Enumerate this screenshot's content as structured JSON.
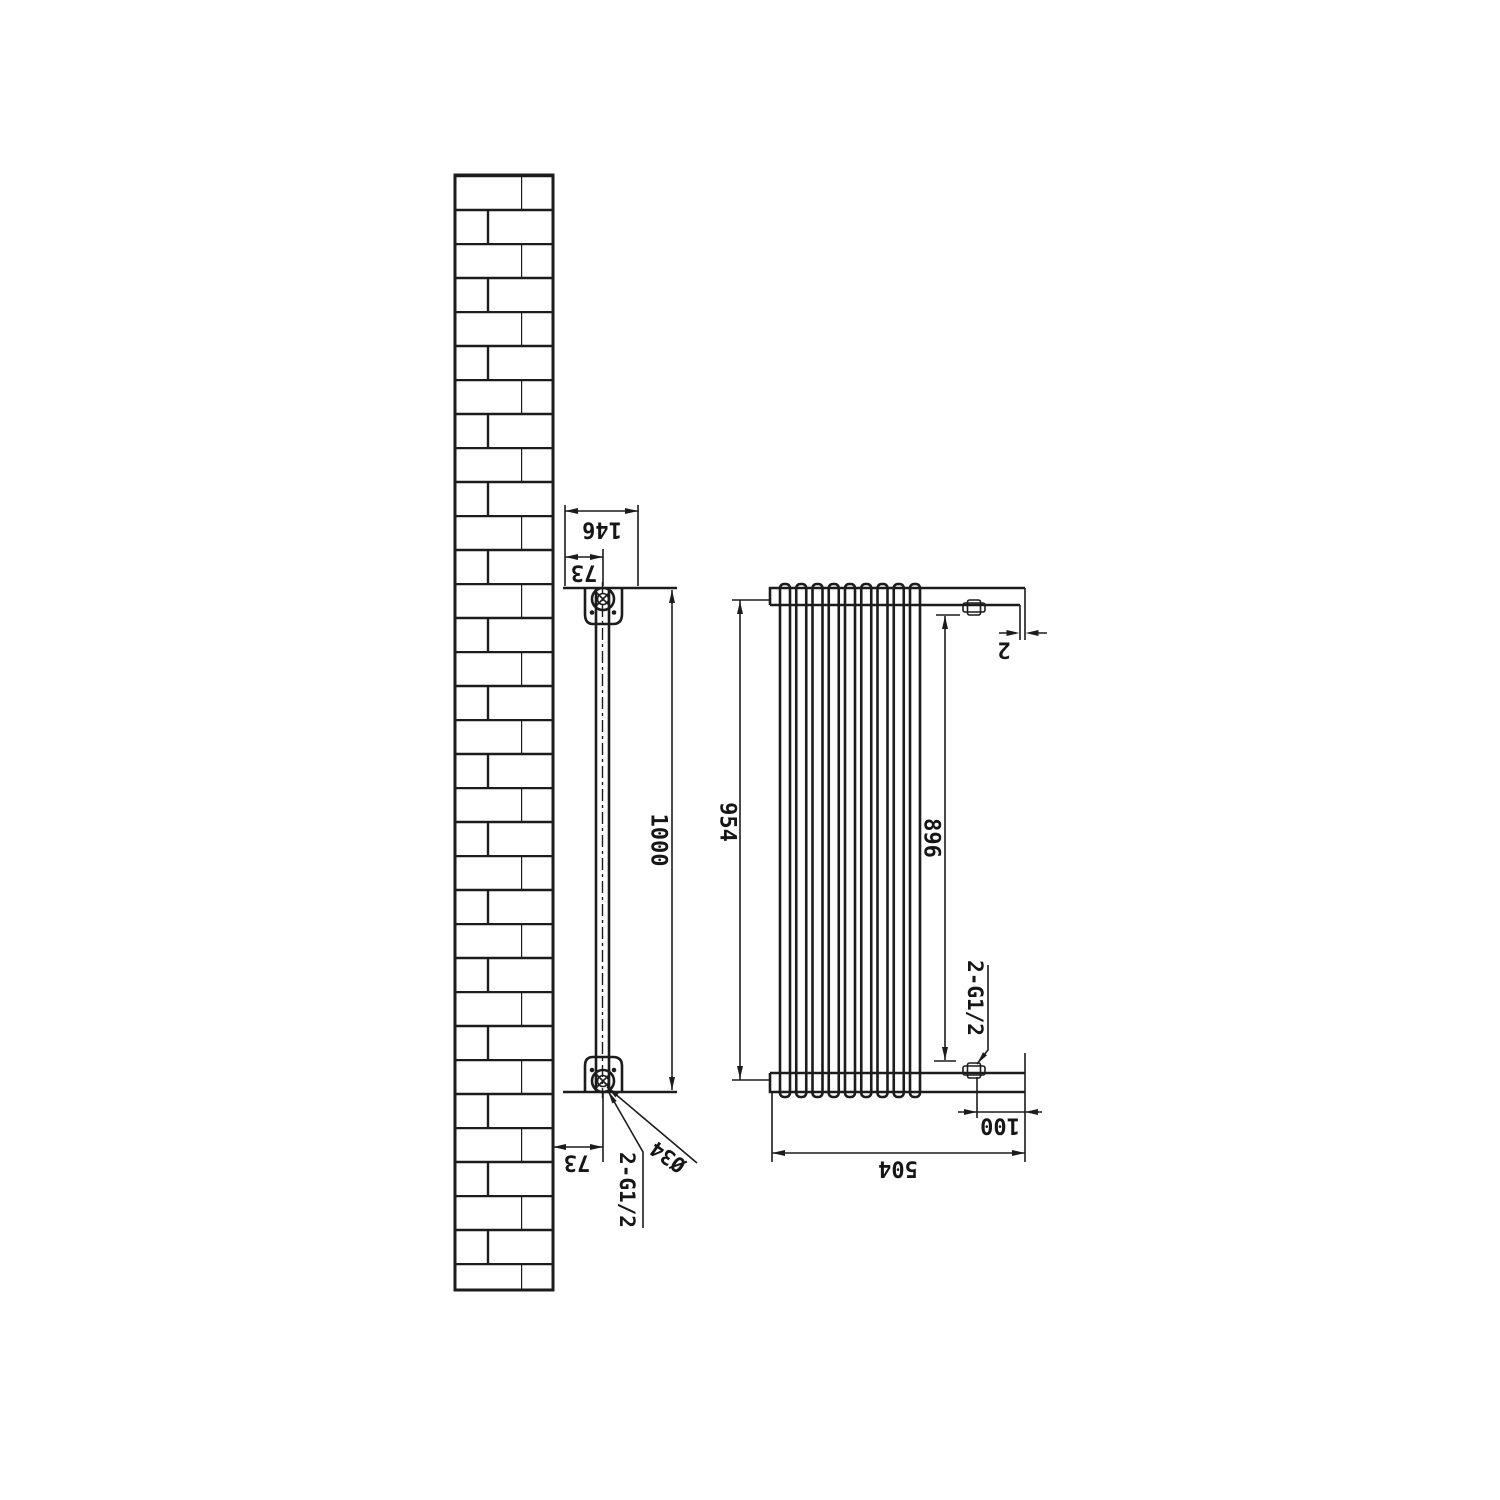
{
  "drawing": {
    "side_view": {
      "dim_width_146": "146",
      "dim_width_73": "73",
      "dim_height_1000": "1000",
      "dim_offset_73": "73",
      "label_diameter": "Ø34",
      "label_connection": "2-G1/2"
    },
    "front_view": {
      "dim_height_954": "954",
      "dim_height_896": "896",
      "dim_gap_2": "2",
      "dim_offset_100": "100",
      "dim_width_504": "504",
      "label_connection": "2-G1/2"
    }
  }
}
